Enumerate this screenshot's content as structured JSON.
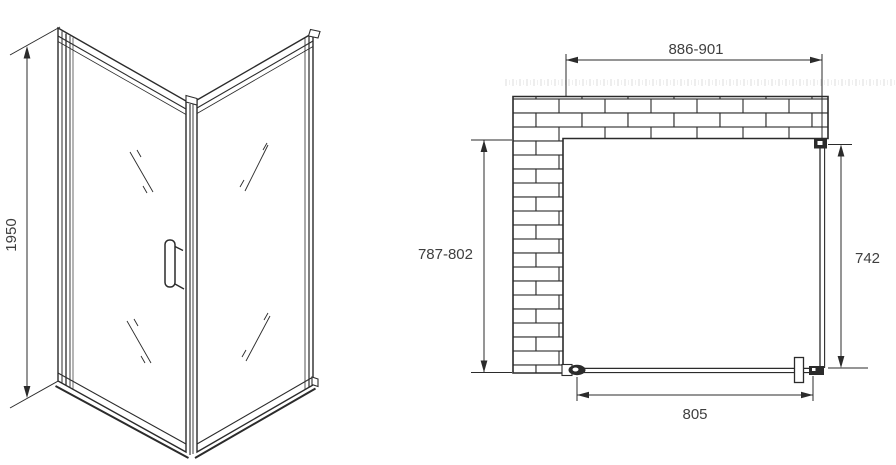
{
  "meta": {
    "drawing_type": "shower enclosure technical drawing",
    "line_color": "#2b2b2b",
    "text_color": "#3f3f3f",
    "background": "#ffffff"
  },
  "front_view": {
    "height_dim": "1950"
  },
  "plan_view": {
    "top_width_dim": "886-901",
    "left_depth_dim": "787-802",
    "right_panel_dim": "742",
    "door_width_dim": "805"
  }
}
